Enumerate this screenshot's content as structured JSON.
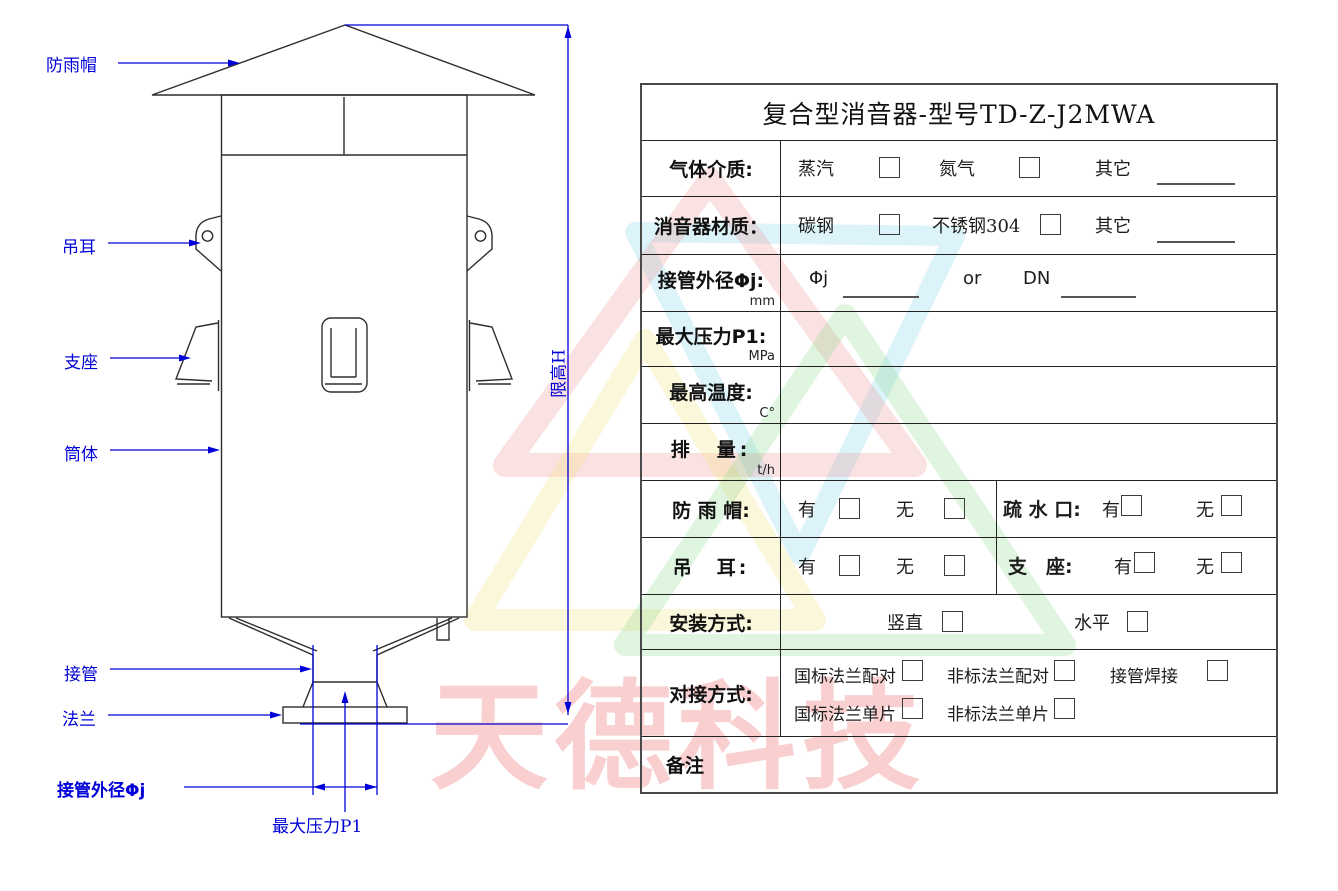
{
  "colors": {
    "annotation_blue": "#0000d8",
    "line_black": "#2e2e2e",
    "watermark_pink": "#ee7878"
  },
  "watermark": {
    "text": "天德科技"
  },
  "drawing": {
    "labels": {
      "rain_cap": "防雨帽",
      "lifting_ear": "吊耳",
      "support": "支座",
      "shell": "筒体",
      "pipe": "接管",
      "flange": "法兰",
      "pipe_od": "接管外径Φj",
      "max_pressure": "最大压力P1",
      "height_limit": "限高H"
    }
  },
  "form": {
    "title": "复合型消音器-型号TD-Z-J2MWA",
    "gas_medium": {
      "label": "气体介质:",
      "option1": "蒸汽",
      "option2": "氮气",
      "other": "其它"
    },
    "material": {
      "label": "消音器材质：",
      "option1": "碳钢",
      "option2": "不锈钢304",
      "other": "其它"
    },
    "pipe_od": {
      "label": "接管外径Φj:",
      "unit": "mm",
      "phi": "Φj",
      "or": "or",
      "dn": "DN"
    },
    "max_pressure": {
      "label": "最大压力P1:",
      "unit": "MPa"
    },
    "max_temp": {
      "label": "最高温度:",
      "unit": "C°"
    },
    "displacement": {
      "label": "排　量:",
      "unit": "t/h"
    },
    "rain_cap": {
      "label": "防 雨 帽:",
      "yes": "有",
      "no": "无"
    },
    "drain": {
      "label": "疏 水 口:",
      "yes": "有",
      "no": "无"
    },
    "lifting_ear": {
      "label": "吊　耳:",
      "yes": "有",
      "no": "无"
    },
    "support": {
      "label": "支　座:",
      "yes": "有",
      "no": "无"
    },
    "install": {
      "label": "安装方式:",
      "option1": "竖直",
      "option2": "水平"
    },
    "connection": {
      "label": "对接方式:",
      "option1": "国标法兰配对",
      "option2": "非标法兰配对",
      "option3": "接管焊接",
      "option4": "国标法兰单片",
      "option5": "非标法兰单片"
    },
    "remark": {
      "label": "备注"
    }
  }
}
